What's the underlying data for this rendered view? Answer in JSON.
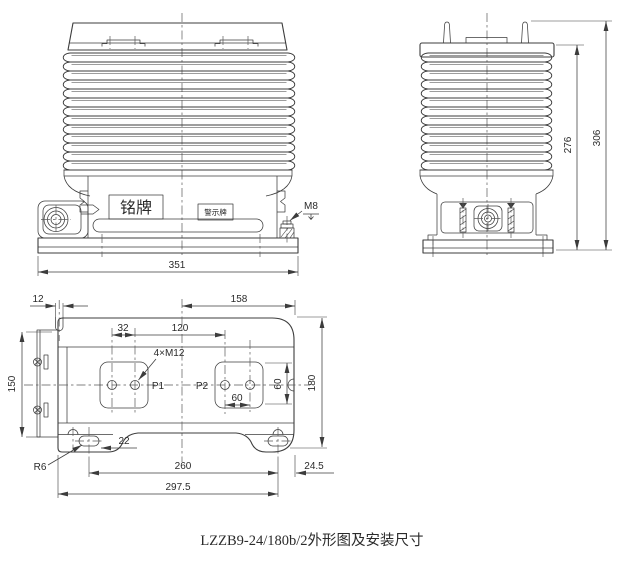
{
  "colors": {
    "line": "#3c3c3c",
    "background": "#ffffff"
  },
  "caption": "LZZB9-24/180b/2外形图及安装尺寸",
  "front_view": {
    "nameplate": "铭牌",
    "warning_plate": "警示牌",
    "bolt": "M8",
    "width": "351"
  },
  "side_view": {
    "body_height": "276",
    "total_height": "306"
  },
  "plan_view": {
    "slot_width": "12",
    "center_to_edge": "158",
    "hole_pitch_inner": "32",
    "hole_pitch_outer": "120",
    "thread_spec": "4×M12",
    "terminal_p1": "P1",
    "terminal_p2": "P2",
    "hole_pitch_60": "60",
    "pad_height_60": "60",
    "depth_inner": "150",
    "depth_total": "180",
    "slot_length": "22",
    "fillet_radius": "R6",
    "mount_pitch": "260",
    "mount_edge_offset": "24.5",
    "base_length": "297.5"
  }
}
